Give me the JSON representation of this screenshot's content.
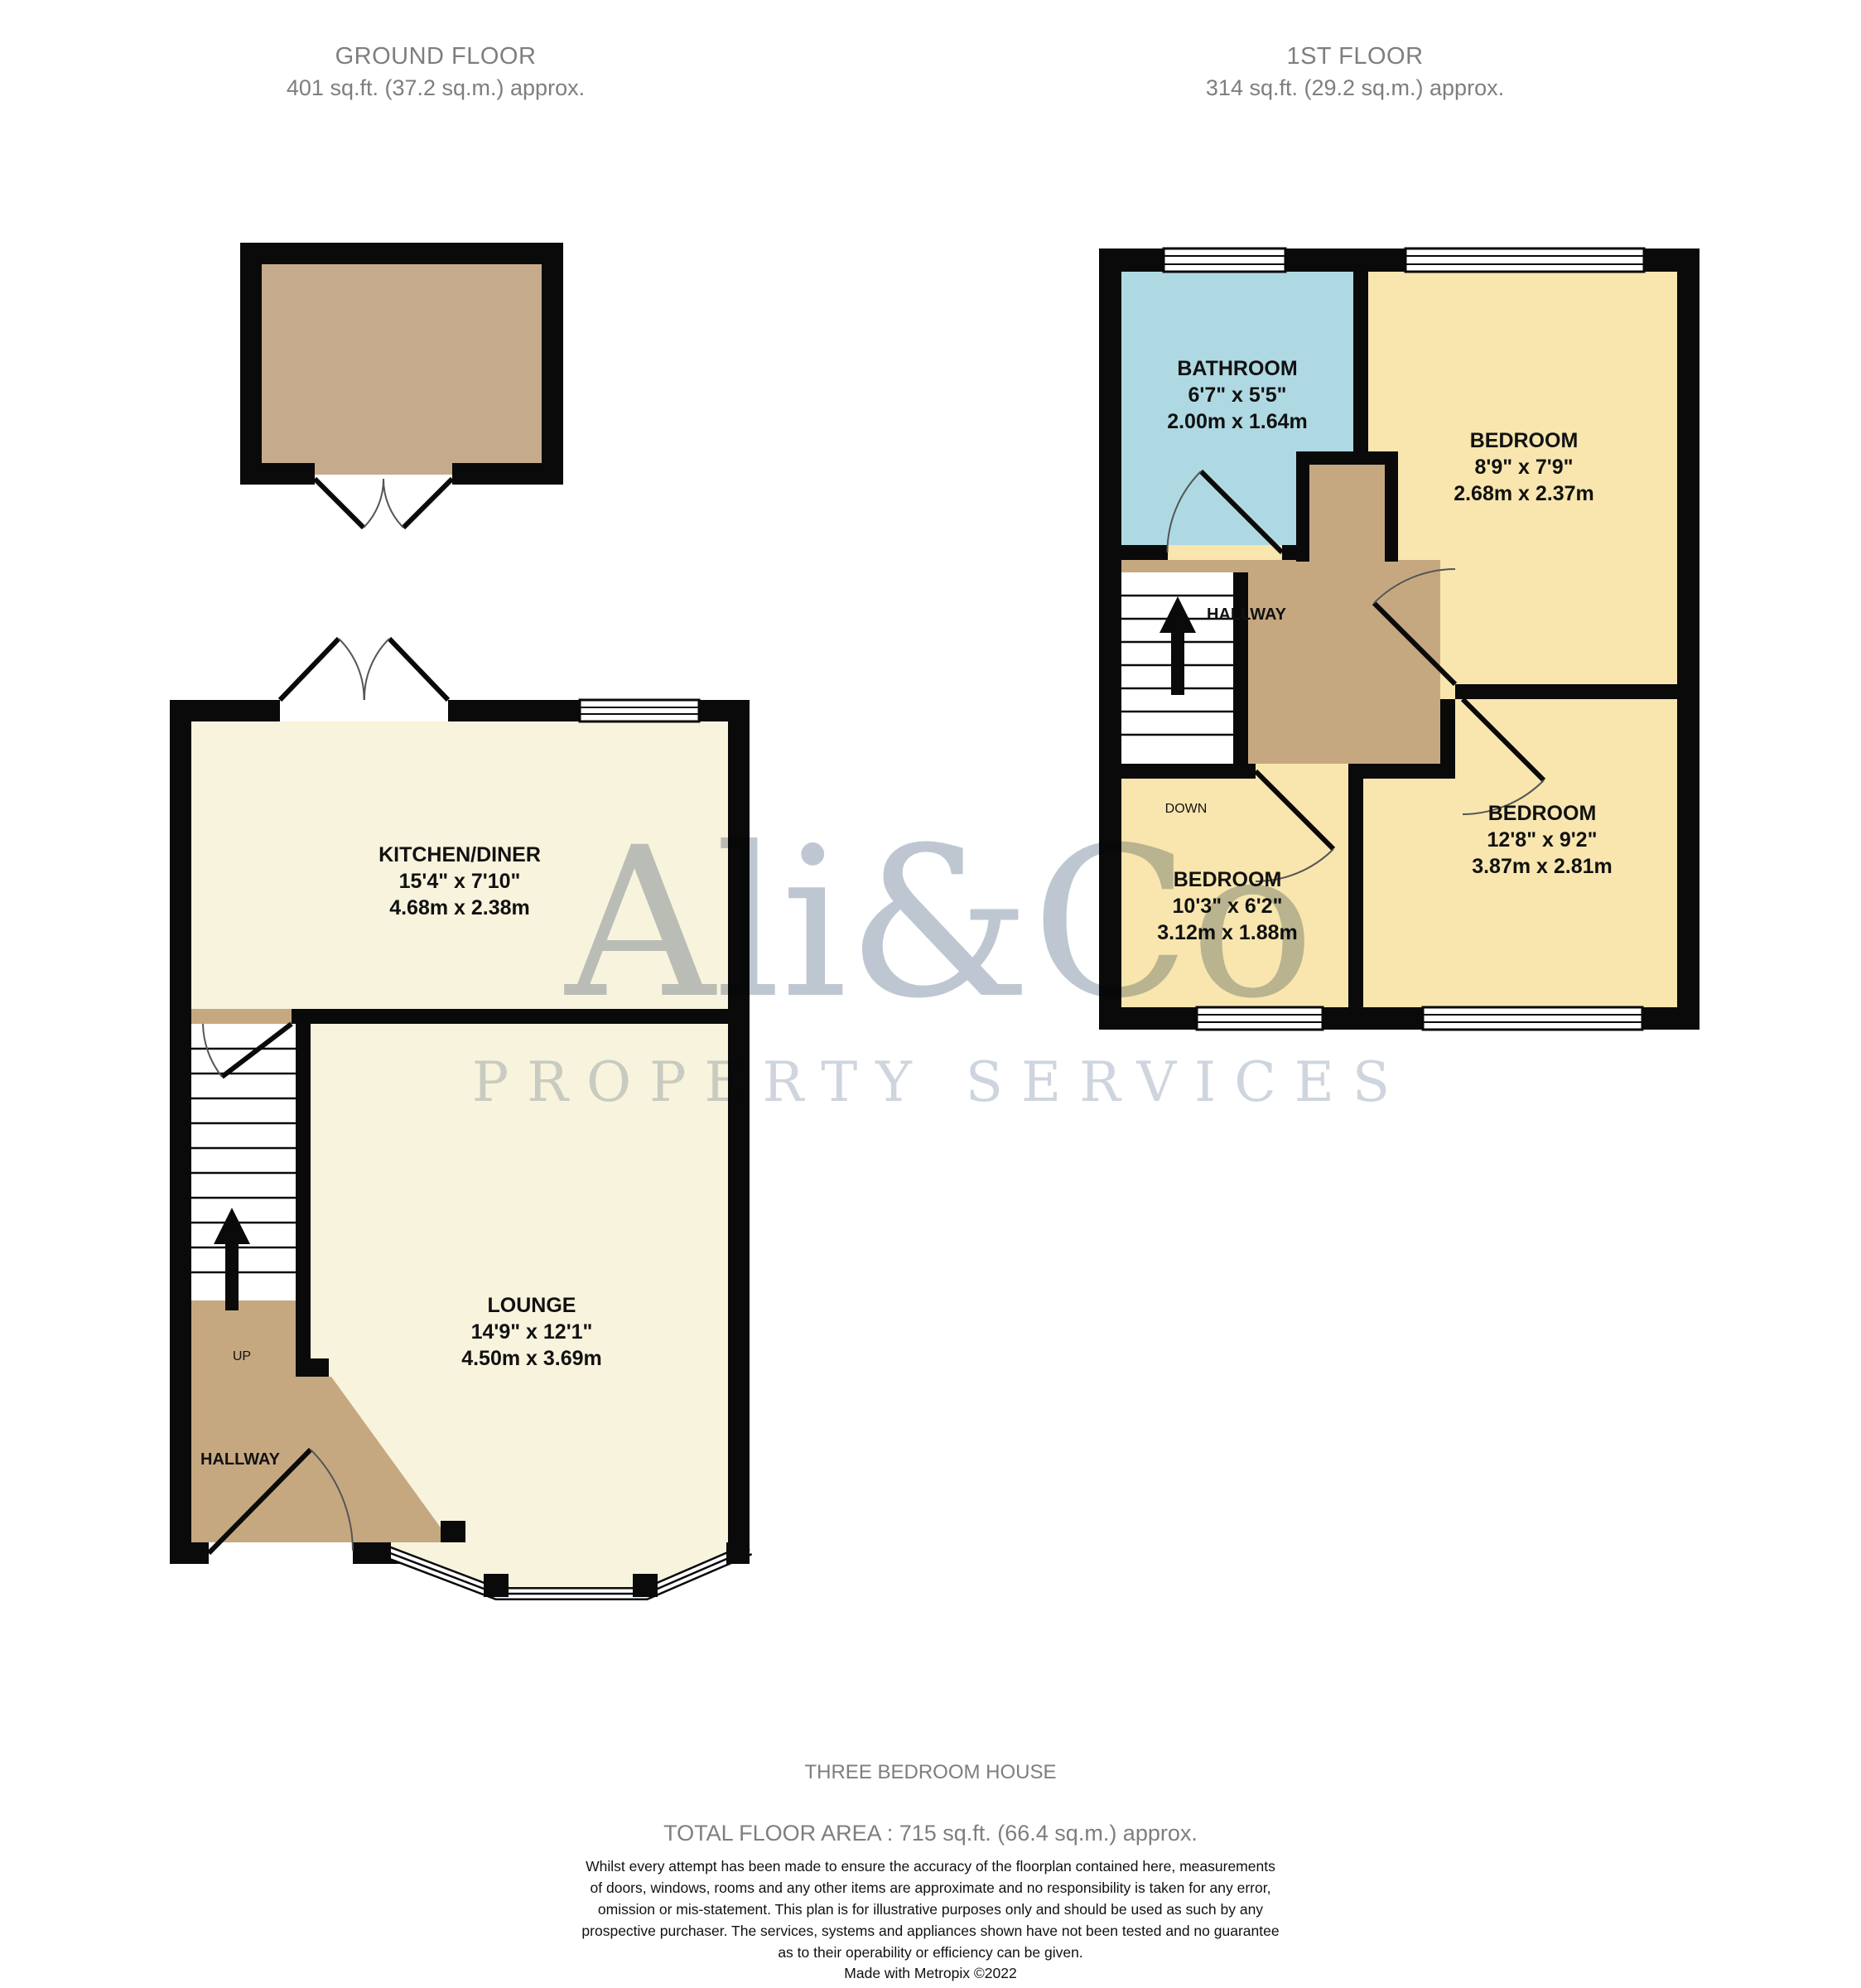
{
  "ground_floor": {
    "title": "GROUND FLOOR",
    "area": "401 sq.ft. (37.2 sq.m.) approx.",
    "rooms": {
      "kitchen": {
        "name": "KITCHEN/DINER",
        "imperial": "15'4\" x 7'10\"",
        "metric": "4.68m x 2.38m"
      },
      "lounge": {
        "name": "LOUNGE",
        "imperial": "14'9\" x 12'1\"",
        "metric": "4.50m x 3.69m"
      },
      "hallway": {
        "name": "HALLWAY"
      }
    },
    "stairs_label": "UP"
  },
  "first_floor": {
    "title": "1ST FLOOR",
    "area": "314 sq.ft. (29.2 sq.m.) approx.",
    "rooms": {
      "bathroom": {
        "name": "BATHROOM",
        "imperial": "6'7\" x 5'5\"",
        "metric": "2.00m x 1.64m"
      },
      "bedroom1": {
        "name": "BEDROOM",
        "imperial": "8'9\" x 7'9\"",
        "metric": "2.68m x 2.37m"
      },
      "bedroom2": {
        "name": "BEDROOM",
        "imperial": "12'8\" x 9'2\"",
        "metric": "3.87m x 2.81m"
      },
      "bedroom3": {
        "name": "BEDROOM",
        "imperial": "10'3\" x 6'2\"",
        "metric": "3.12m x 1.88m"
      },
      "hallway": {
        "name": "HALLWAY"
      }
    },
    "stairs_label": "DOWN"
  },
  "watermark": {
    "line1": "Ali&Co",
    "line2": "PROPERTY SERVICES"
  },
  "footer": {
    "property_type": "THREE BEDROOM HOUSE",
    "total_area": "TOTAL FLOOR AREA : 715 sq.ft. (66.4 sq.m.) approx.",
    "disclaimer_lines": [
      "Whilst every attempt has been made to ensure the accuracy of the floorplan contained here, measurements",
      "of doors, windows, rooms and any other items are approximate and no responsibility is taken for any error,",
      "omission or mis-statement. This plan is for illustrative purposes only and should be used as such by any",
      "prospective purchaser. The services, systems and appliances shown have not been tested and no guarantee",
      "as to their operability or efficiency can be given."
    ],
    "credit": "Made with Metropix ©2022"
  },
  "colors": {
    "wall": "#0a0a0a",
    "ground_room_fill": "#f8f3dd",
    "bedroom_fill": "#f8e6ae",
    "bathroom_fill": "#afd9e2",
    "hallway_fill": "#c6a880",
    "garage_fill": "#c5ab8b",
    "heading_gray": "#7e7e7e",
    "watermark_gray": "#aeb9c6"
  }
}
